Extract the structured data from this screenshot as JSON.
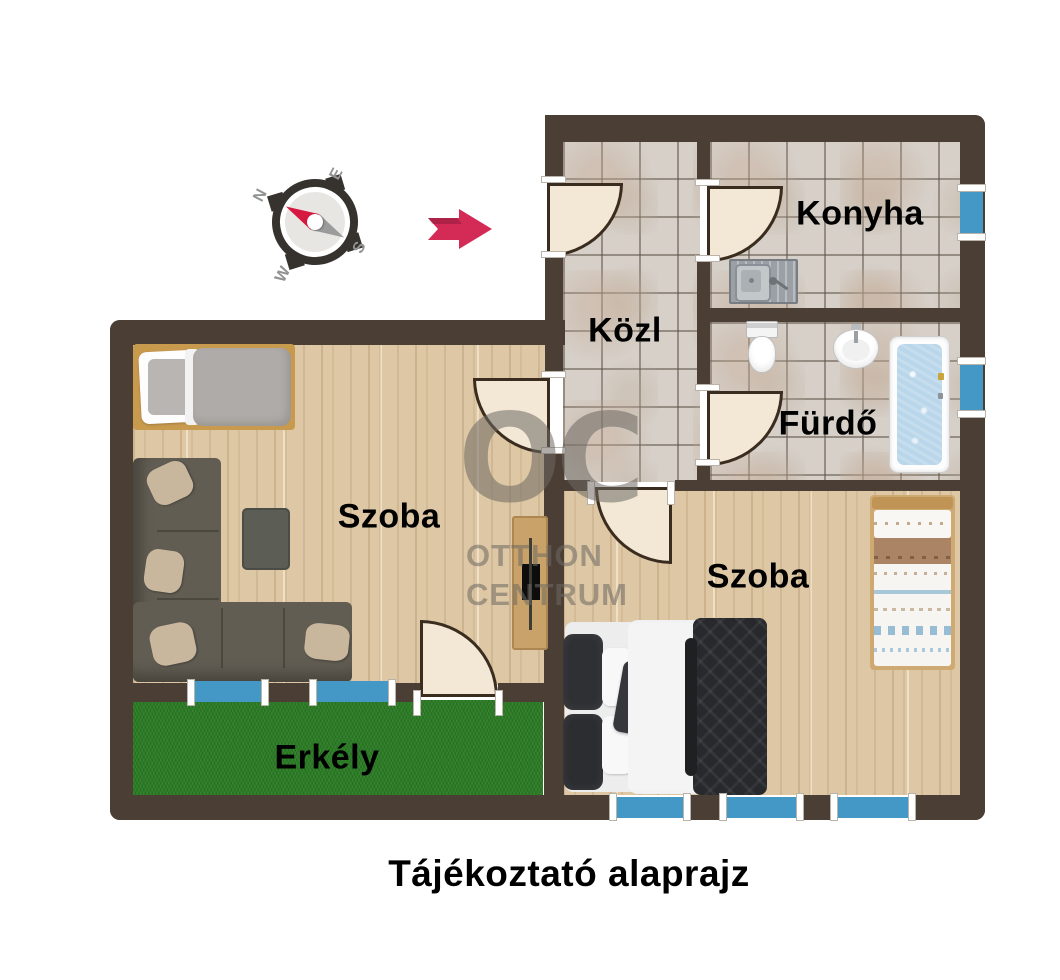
{
  "caption": "Tájékoztató alaprajz",
  "rooms": {
    "konyha": {
      "label": "Konyha"
    },
    "kozl": {
      "label": "Közl"
    },
    "furdo": {
      "label": "Fürdő"
    },
    "szoba_left": {
      "label": "Szoba"
    },
    "szoba_right": {
      "label": "Szoba"
    },
    "erkely": {
      "label": "Erkély"
    }
  },
  "compass": {
    "north": "N",
    "east": "E",
    "south": "S",
    "west": "W"
  },
  "watermark": {
    "monogram": "OC",
    "line1": "OTTHON",
    "line2": "CENTRUM"
  },
  "colors": {
    "wall": "#4b3e34",
    "tile_floor": "#d6d0c9",
    "wood_floor": "#ddc7a4",
    "balcony_green": "#2b7c25",
    "window_blue": "#4498c6",
    "door_cream": "#f3e8d5",
    "arrow_red": "#d42a56",
    "compass_dark": "#36322e",
    "watermark_gray": "#6e6a64",
    "label_text": "#000000"
  }
}
